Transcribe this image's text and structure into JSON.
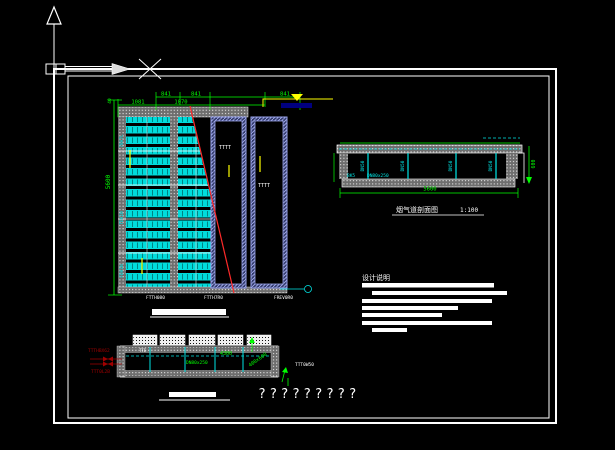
{
  "colors": {
    "background": "#000000",
    "line_white": "#FFFFFF",
    "dimension_green": "#00FF00",
    "detail_cyan": "#00E5E5",
    "cut_line_red": "#FF2A2A",
    "steel_blue": "#9AA4EC",
    "annotation_dark_red": "#A00000",
    "highlight_yellow": "#FFFF00",
    "leader_navy": "#000080"
  },
  "plan": {
    "dims_upper": [
      "841",
      "841",
      "841"
    ],
    "dims_lower": [
      "1081",
      "1070"
    ],
    "dim_left_top": "40",
    "dim_left": "5600",
    "row_labels": [
      "78H7L",
      "TDH1N",
      "FDH1N"
    ],
    "shaft_labels": [
      "TTTT",
      "TTTT"
    ],
    "bottom_labels": [
      "FTTH080",
      "FTTH7R0",
      "FREV0R0"
    ]
  },
  "section_top": {
    "divider_labels": [
      "DN50",
      "DN50",
      "DN50",
      "DN50"
    ],
    "side_label_1": "BK5",
    "side_label_2": "DN80x250",
    "bottom_dim": "5600",
    "right_dim": "600",
    "title": "烟气道剖面图",
    "scale": "1:100"
  },
  "notes": {
    "heading": "设计说明"
  },
  "section_bottom": {
    "left_note_1": "TTTHBX62",
    "left_note_2": "TTT0L2B",
    "dim_1": "4300",
    "duct_label": "DN80x250",
    "rotated_label": "400x600",
    "right_note": "TTT0W50",
    "small_note": "TTE"
  },
  "footer": {
    "missing_text": "?????????"
  }
}
